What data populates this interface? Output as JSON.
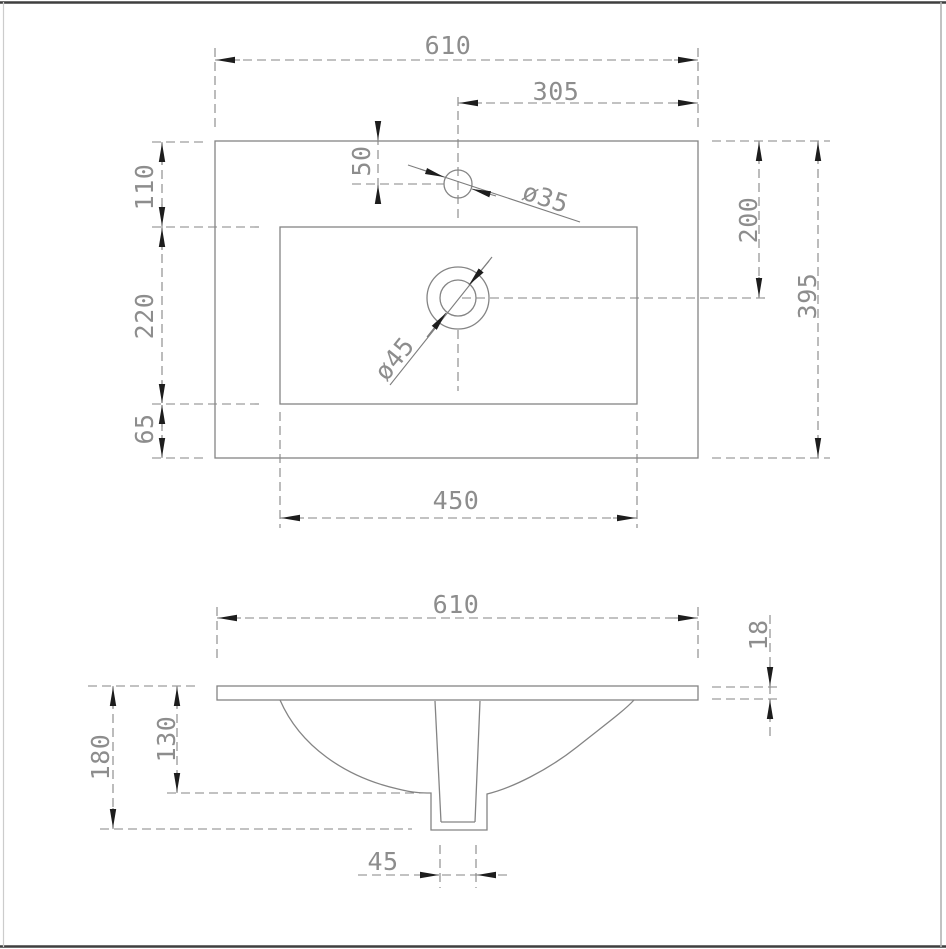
{
  "colors": {
    "background": "#ffffff",
    "line_gray": "#848484",
    "text_gray": "#8d8d8d",
    "arrow_black": "#1d1d1d",
    "frame_dark": "#3f3f3f"
  },
  "top_view": {
    "dims": {
      "overall_width": "610",
      "faucet_to_right_edge": "305",
      "faucet_from_back_edge": "50",
      "faucet_hole_diameter": "ø35",
      "back_deck_depth": "110",
      "basin_front_to_back": "220",
      "front_deck_depth": "65",
      "basin_left_to_right": "450",
      "drain_from_back_edge": "200",
      "overall_depth": "395",
      "drain_hole_diameter": "ø45"
    }
  },
  "front_view": {
    "dims": {
      "overall_width": "610",
      "slab_thickness": "18",
      "overall_height": "180",
      "bowl_depth": "130",
      "drain_outlet_width": "45"
    }
  }
}
